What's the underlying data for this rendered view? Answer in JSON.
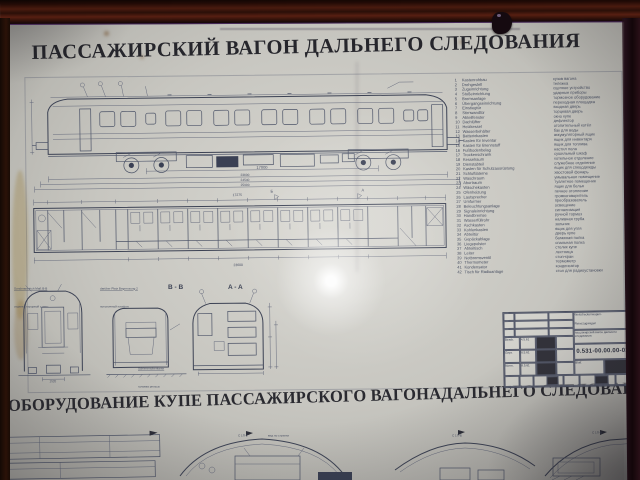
{
  "poster": {
    "title_top": "ПАССАЖИРСКИЙ ВАГОН ДАЛЬНЕГО СЛЕДОВАНИЯ",
    "title_bottom_1": "ОБОРУДОВАНИЕ КУПЕ ПАССАЖИРСКОГО ВАГОНА",
    "title_bottom_2": "ДАЛЬНЕГО СЛЕДОВАНИЯ"
  },
  "side_view": {
    "dims": {
      "bogie_centers": "17000",
      "body_length": "23600",
      "over_buffers": "24540",
      "overall": "25900"
    }
  },
  "floor_plan": {
    "dim_top": "17275",
    "dim_bottom": "23600",
    "section_mark_b": "Б",
    "section_mark_a": "А"
  },
  "sections": {
    "label_bb": "B - B",
    "label_aa": "A - A",
    "note_end_de": "Sonderanstrich Maß B-B",
    "note_end_ru": "отделка торцовой стены",
    "note_mid_de": "darüber Platz Begrenzung 2",
    "note_mid_ru": "потолочный плафон",
    "rail_de": "Schienenoberkante",
    "rail_ru": "головка рельса",
    "end_gauge": "1520"
  },
  "legend": {
    "rows": [
      {
        "n": "1",
        "de": "Kastenrohbau",
        "ru": "кузов вагона"
      },
      {
        "n": "2",
        "de": "Drehgestell",
        "ru": "тележка"
      },
      {
        "n": "3",
        "de": "Zugeinrichtung",
        "ru": "сцепное устройство"
      },
      {
        "n": "4",
        "de": "Stoßeinrichtung",
        "ru": "ударные приборы"
      },
      {
        "n": "5",
        "de": "Bremsanlage",
        "ru": "тормозное оборудование"
      },
      {
        "n": "6",
        "de": "Übergangseinrichtung",
        "ru": "переходная площадка"
      },
      {
        "n": "7",
        "de": "Einstiegtür",
        "ru": "входная дверь"
      },
      {
        "n": "8",
        "de": "Stirnwandtür",
        "ru": "торцевая дверь"
      },
      {
        "n": "9",
        "de": "Abteilfenster",
        "ru": "окно купе"
      },
      {
        "n": "10",
        "de": "Dachlüfter",
        "ru": "дефлектор"
      },
      {
        "n": "11",
        "de": "Heizkessel",
        "ru": "отопительный котёл"
      },
      {
        "n": "12",
        "de": "Wasserbehälter",
        "ru": "бак для воды"
      },
      {
        "n": "13",
        "de": "Batteriekasten",
        "ru": "аккумуляторный ящик"
      },
      {
        "n": "14",
        "de": "Kasten für Inventar",
        "ru": "ящик для инвентаря"
      },
      {
        "n": "15",
        "de": "Kasten für Brennstoff",
        "ru": "ящик для топлива"
      },
      {
        "n": "16",
        "de": "Fußbodenbelag",
        "ru": "настил пола"
      },
      {
        "n": "17",
        "de": "Trockenschrank",
        "ru": "сушильный шкаф"
      },
      {
        "n": "18",
        "de": "Kesselraum",
        "ru": "котельное отделение"
      },
      {
        "n": "19",
        "de": "Dienstabteil",
        "ru": "служебное отделение"
      },
      {
        "n": "20",
        "de": "Kasten für Schutzausrüstung",
        "ru": "ящик для спецодежды"
      },
      {
        "n": "21",
        "de": "Schlußlaterne",
        "ru": "хвостовой фонарь"
      },
      {
        "n": "22",
        "de": "Waschraum",
        "ru": "умывальное помещение"
      },
      {
        "n": "23",
        "de": "Abortraum",
        "ru": "туалетное помещение"
      },
      {
        "n": "24",
        "de": "Wäschekasten",
        "ru": "ящик для белья"
      },
      {
        "n": "25",
        "de": "Ofenheizung",
        "ru": "печное отопление"
      },
      {
        "n": "26",
        "de": "Lautsprecher",
        "ru": "громкоговоритель"
      },
      {
        "n": "27",
        "de": "Umformer",
        "ru": "преобразователь"
      },
      {
        "n": "28",
        "de": "Beleuchtungsanlage",
        "ru": "освещение"
      },
      {
        "n": "29",
        "de": "Signaleinrichtung",
        "ru": "сигнализация"
      },
      {
        "n": "30",
        "de": "Handbremse",
        "ru": "ручной тормоз"
      },
      {
        "n": "31",
        "de": "Wasserfüllrohr",
        "ru": "наливная труба"
      },
      {
        "n": "32",
        "de": "Aschkasten",
        "ru": "зольник"
      },
      {
        "n": "33",
        "de": "Kohlenkasten",
        "ru": "ящик для угля"
      },
      {
        "n": "34",
        "de": "Abteiltür",
        "ru": "дверь купе"
      },
      {
        "n": "35",
        "de": "Gepäckablage",
        "ru": "багажная полка"
      },
      {
        "n": "36",
        "de": "Liegepolster",
        "ru": "спальная полка"
      },
      {
        "n": "37",
        "de": "Abteiltisch",
        "ru": "столик купе"
      },
      {
        "n": "38",
        "de": "Leiter",
        "ru": "лестница"
      },
      {
        "n": "39",
        "de": "Notbremsventil",
        "ru": "стоп-кран"
      },
      {
        "n": "40",
        "de": "Thermometer",
        "ru": "термометр"
      },
      {
        "n": "41",
        "de": "Kondensator",
        "ru": "конденсатор"
      },
      {
        "n": "42",
        "de": "Tisch für Radioanlage",
        "ru": "стол для радиоустановки"
      }
    ]
  },
  "title_block": {
    "name_de_1": "Weitstreckenwagen-",
    "name_de_2": "Reisezugwagen",
    "name_ru": "пассажирский вагон дальнего следования",
    "number": "0.531-00.00.00-01",
    "bearb": "Bearb.",
    "gepr": "Gepr.",
    "norm": "Norm.",
    "datum": "Datum",
    "name": "Name",
    "blatt": "Blatt",
    "bl": "Bl.",
    "date1": "4.5.61",
    "date2": "6.5.61",
    "date3": "8.5.61"
  },
  "bottom_sections": {
    "label_2a": "С 1П-2",
    "label_2b": "вид по стрелке",
    "label_3": "С 1П-Б",
    "label_4": "С 1П-В"
  },
  "colors": {
    "paper": "#c9c8c2",
    "ink": "#4d5468",
    "ink_dark": "#26262c",
    "frame_wood": "#3c1710",
    "glare": "#ffffff"
  }
}
